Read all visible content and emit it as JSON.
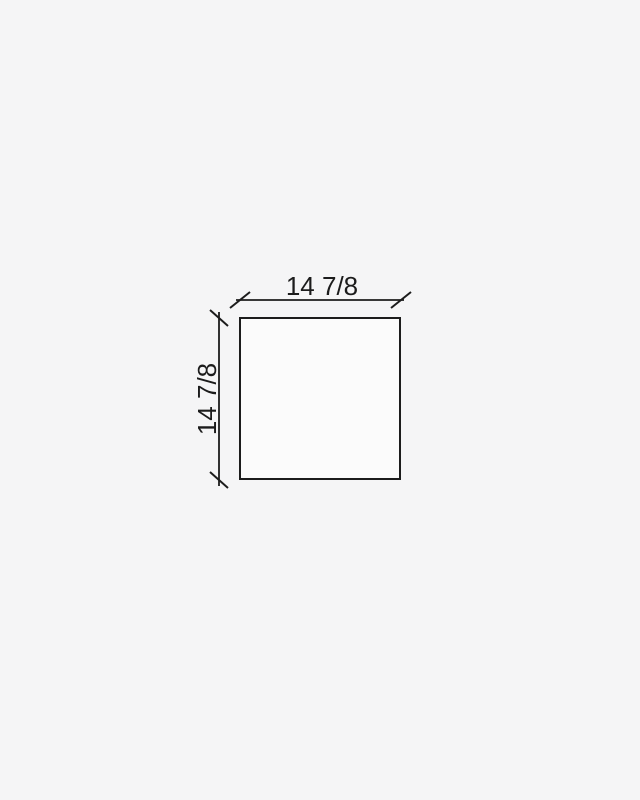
{
  "page": {
    "background_color": "#f5f5f6"
  },
  "drawing": {
    "type": "technical-dimension-diagram",
    "shape": "square",
    "shape_fill_color": "#fbfbfb",
    "line_color": "#1c1c1c",
    "text_color": "#1c1c1c",
    "tick_style": "oblique-slash",
    "width_dimension": {
      "label": "14 7/8"
    },
    "height_dimension": {
      "label": "14 7/8"
    }
  }
}
